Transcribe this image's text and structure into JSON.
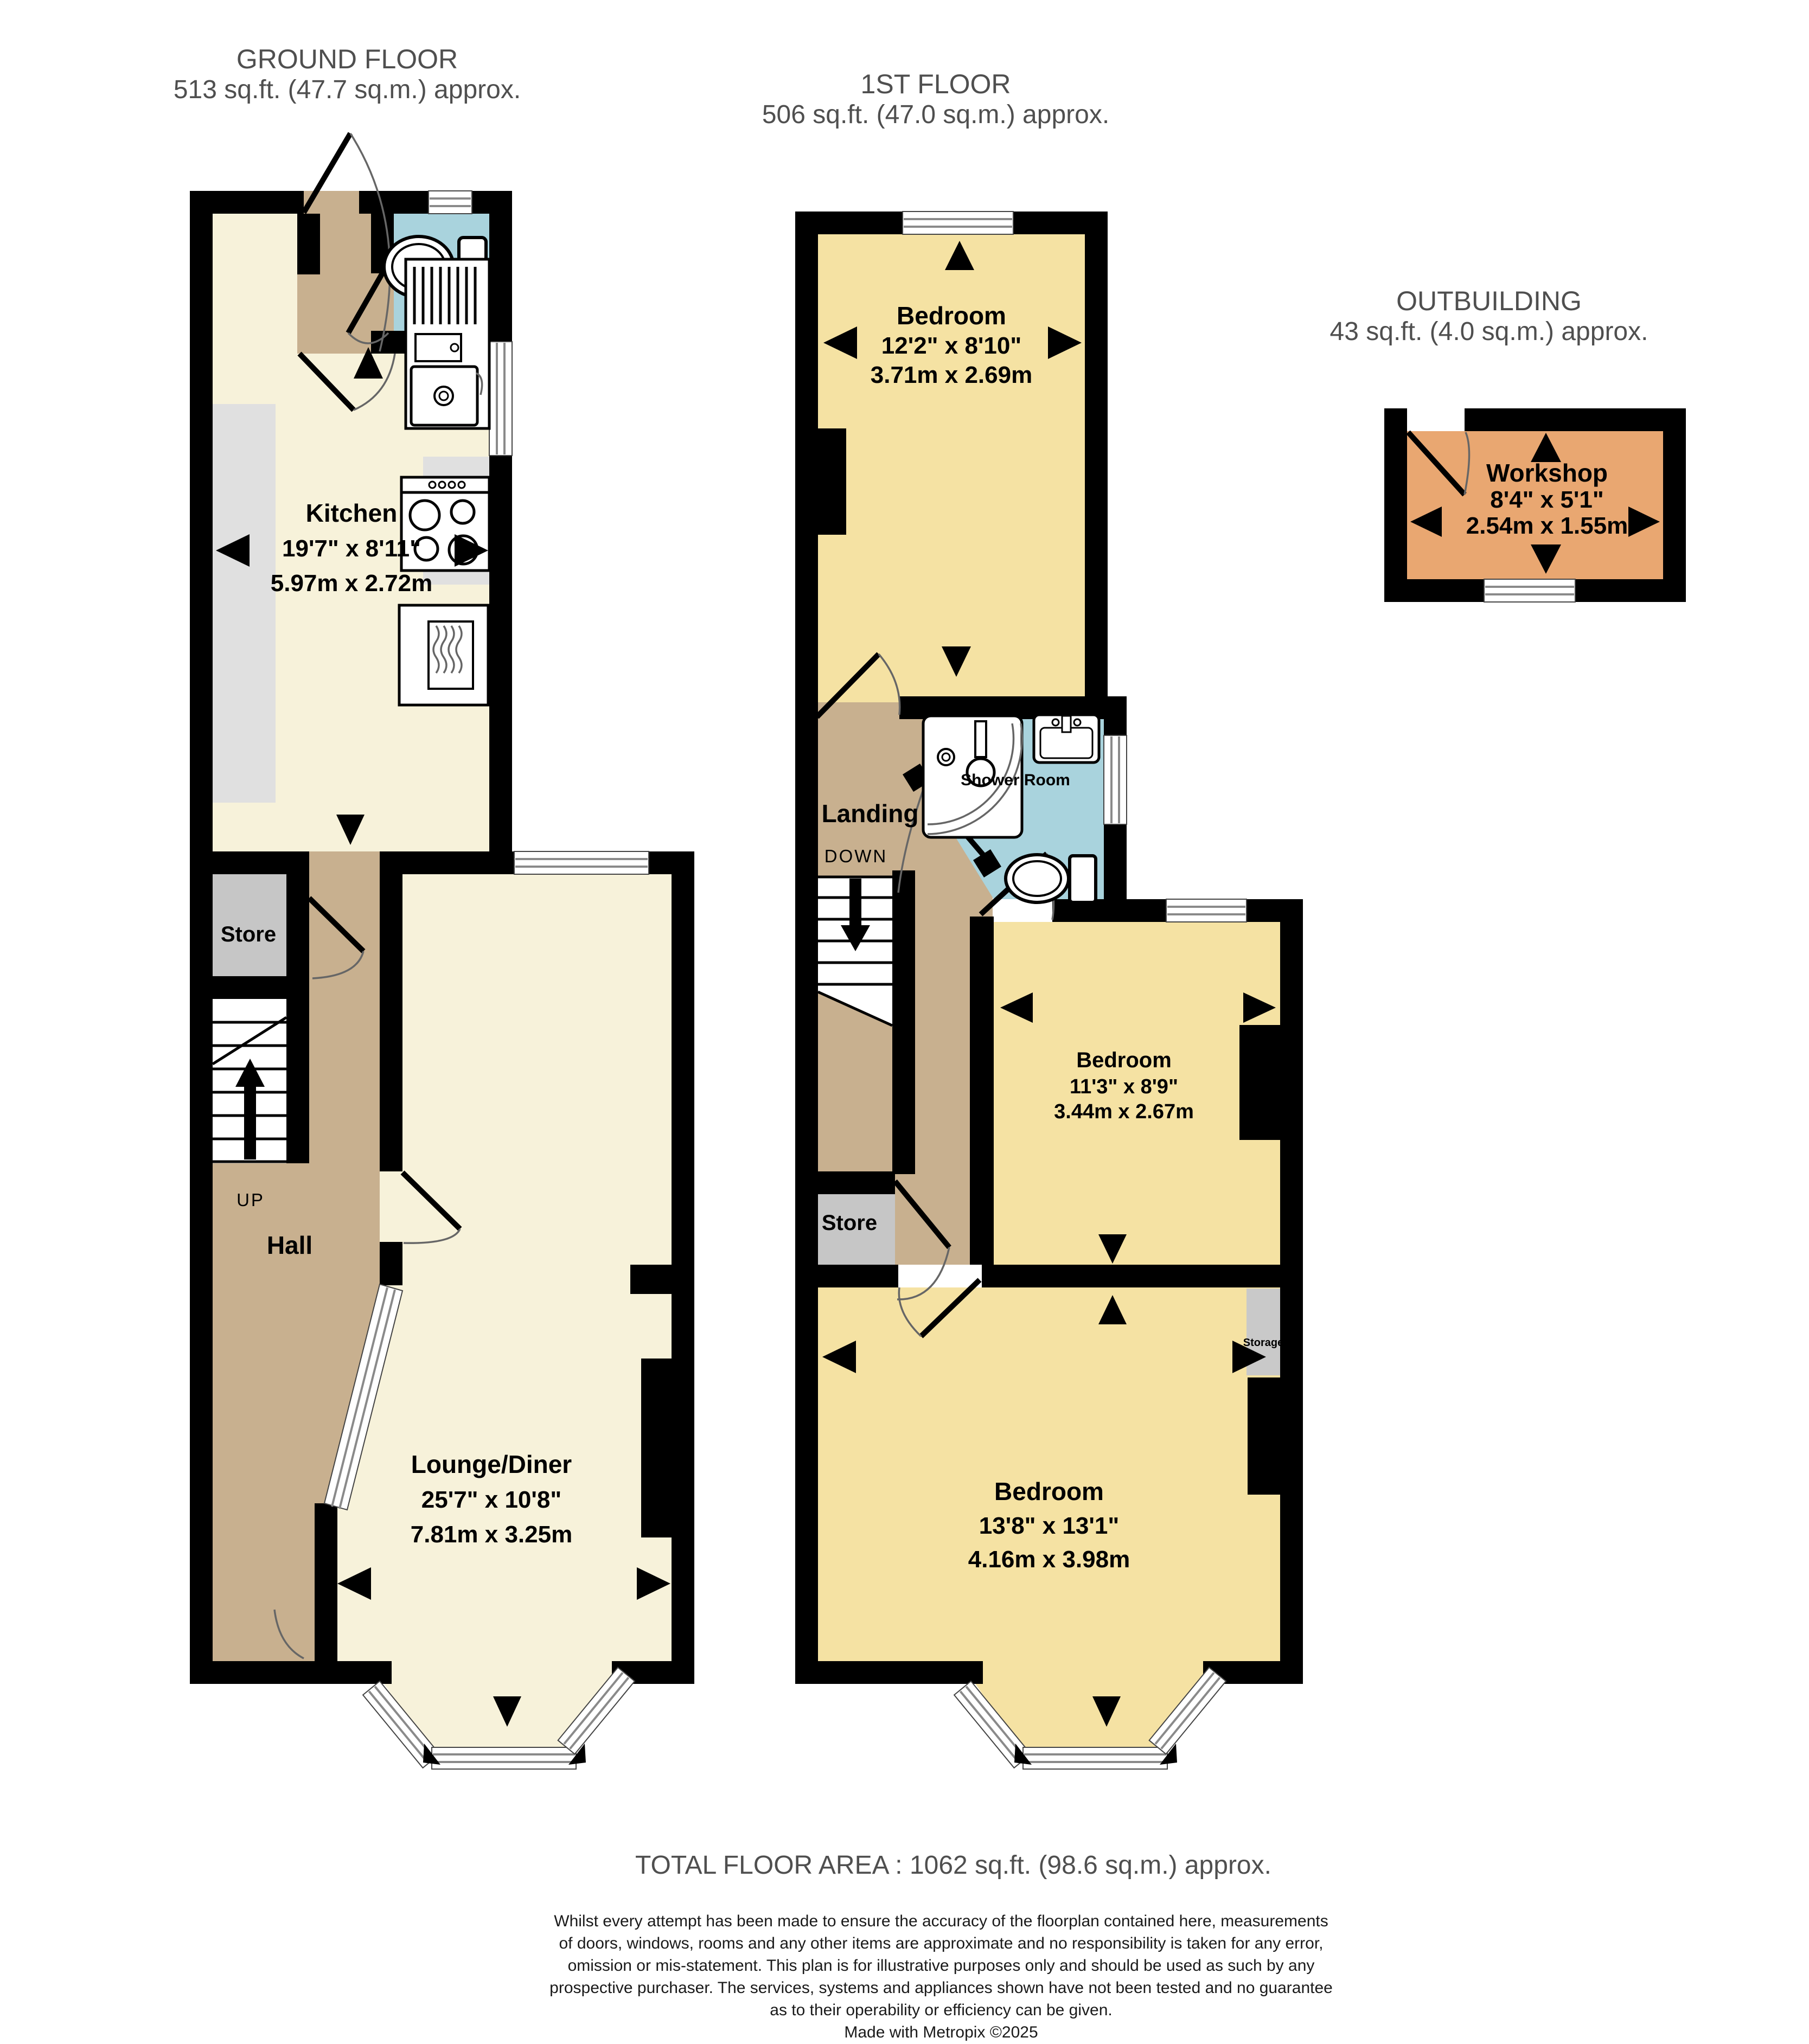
{
  "floors": {
    "ground": {
      "title": "GROUND FLOOR",
      "area": "513 sq.ft. (47.7 sq.m.) approx.",
      "stairs_label": "UP",
      "rooms": {
        "kitchen": {
          "name": "Kitchen",
          "dims_ft": "19'7\"  x 8'11\"",
          "dims_m": "5.97m  x 2.72m"
        },
        "store": {
          "name": "Store"
        },
        "hall": {
          "name": "Hall"
        },
        "lounge": {
          "name": "Lounge/Diner",
          "dims_ft": "25'7\"  x 10'8\"",
          "dims_m": "7.81m  x 3.25m"
        }
      }
    },
    "first": {
      "title": "1ST FLOOR",
      "area": "506 sq.ft. (47.0 sq.m.) approx.",
      "stairs_label": "DOWN",
      "rooms": {
        "bedroom1": {
          "name": "Bedroom",
          "dims_ft": "12'2\"  x 8'10\"",
          "dims_m": "3.71m  x 2.69m"
        },
        "shower_room": {
          "name": "Shower Room"
        },
        "landing": {
          "name": "Landing"
        },
        "store": {
          "name": "Store"
        },
        "bedroom2": {
          "name": "Bedroom",
          "dims_ft": "11'3\"  x 8'9\"",
          "dims_m": "3.44m  x 2.67m"
        },
        "storage": {
          "name": "Storage"
        },
        "bedroom3": {
          "name": "Bedroom",
          "dims_ft": "13'8\"  x 13'1\"",
          "dims_m": "4.16m  x 3.98m"
        }
      }
    },
    "outbuilding": {
      "title": "OUTBUILDING",
      "area": "43 sq.ft. (4.0 sq.m.) approx.",
      "rooms": {
        "workshop": {
          "name": "Workshop",
          "dims_ft": "8'4\"  x 5'1\"",
          "dims_m": "2.54m  x 1.55m"
        }
      }
    }
  },
  "footer": {
    "total_area": "TOTAL FLOOR AREA : 1062 sq.ft. (98.6 sq.m.) approx.",
    "disclaimer_lines": [
      "Whilst every attempt has been made to ensure the accuracy of the floorplan contained here, measurements",
      "of doors, windows, rooms and any other items are approximate and no responsibility is taken for any error,",
      "omission or mis-statement. This plan is for illustrative purposes only and should be used as such by any",
      "prospective purchaser. The services, systems and appliances shown have not been tested and no guarantee",
      "as to their operability or efficiency can be given.",
      "Made with Metropix ©2025"
    ]
  },
  "colors": {
    "wall": "#000000",
    "ground_floor_room": "#f7f2da",
    "first_floor_room": "#f5e2a3",
    "hall_landing": "#c8b08f",
    "wet_room": "#a9d3dd",
    "workshop": "#e9a771",
    "store": "#c6c6c6",
    "counter": "#e0e0e0",
    "header_text": "#4f4f4f"
  }
}
